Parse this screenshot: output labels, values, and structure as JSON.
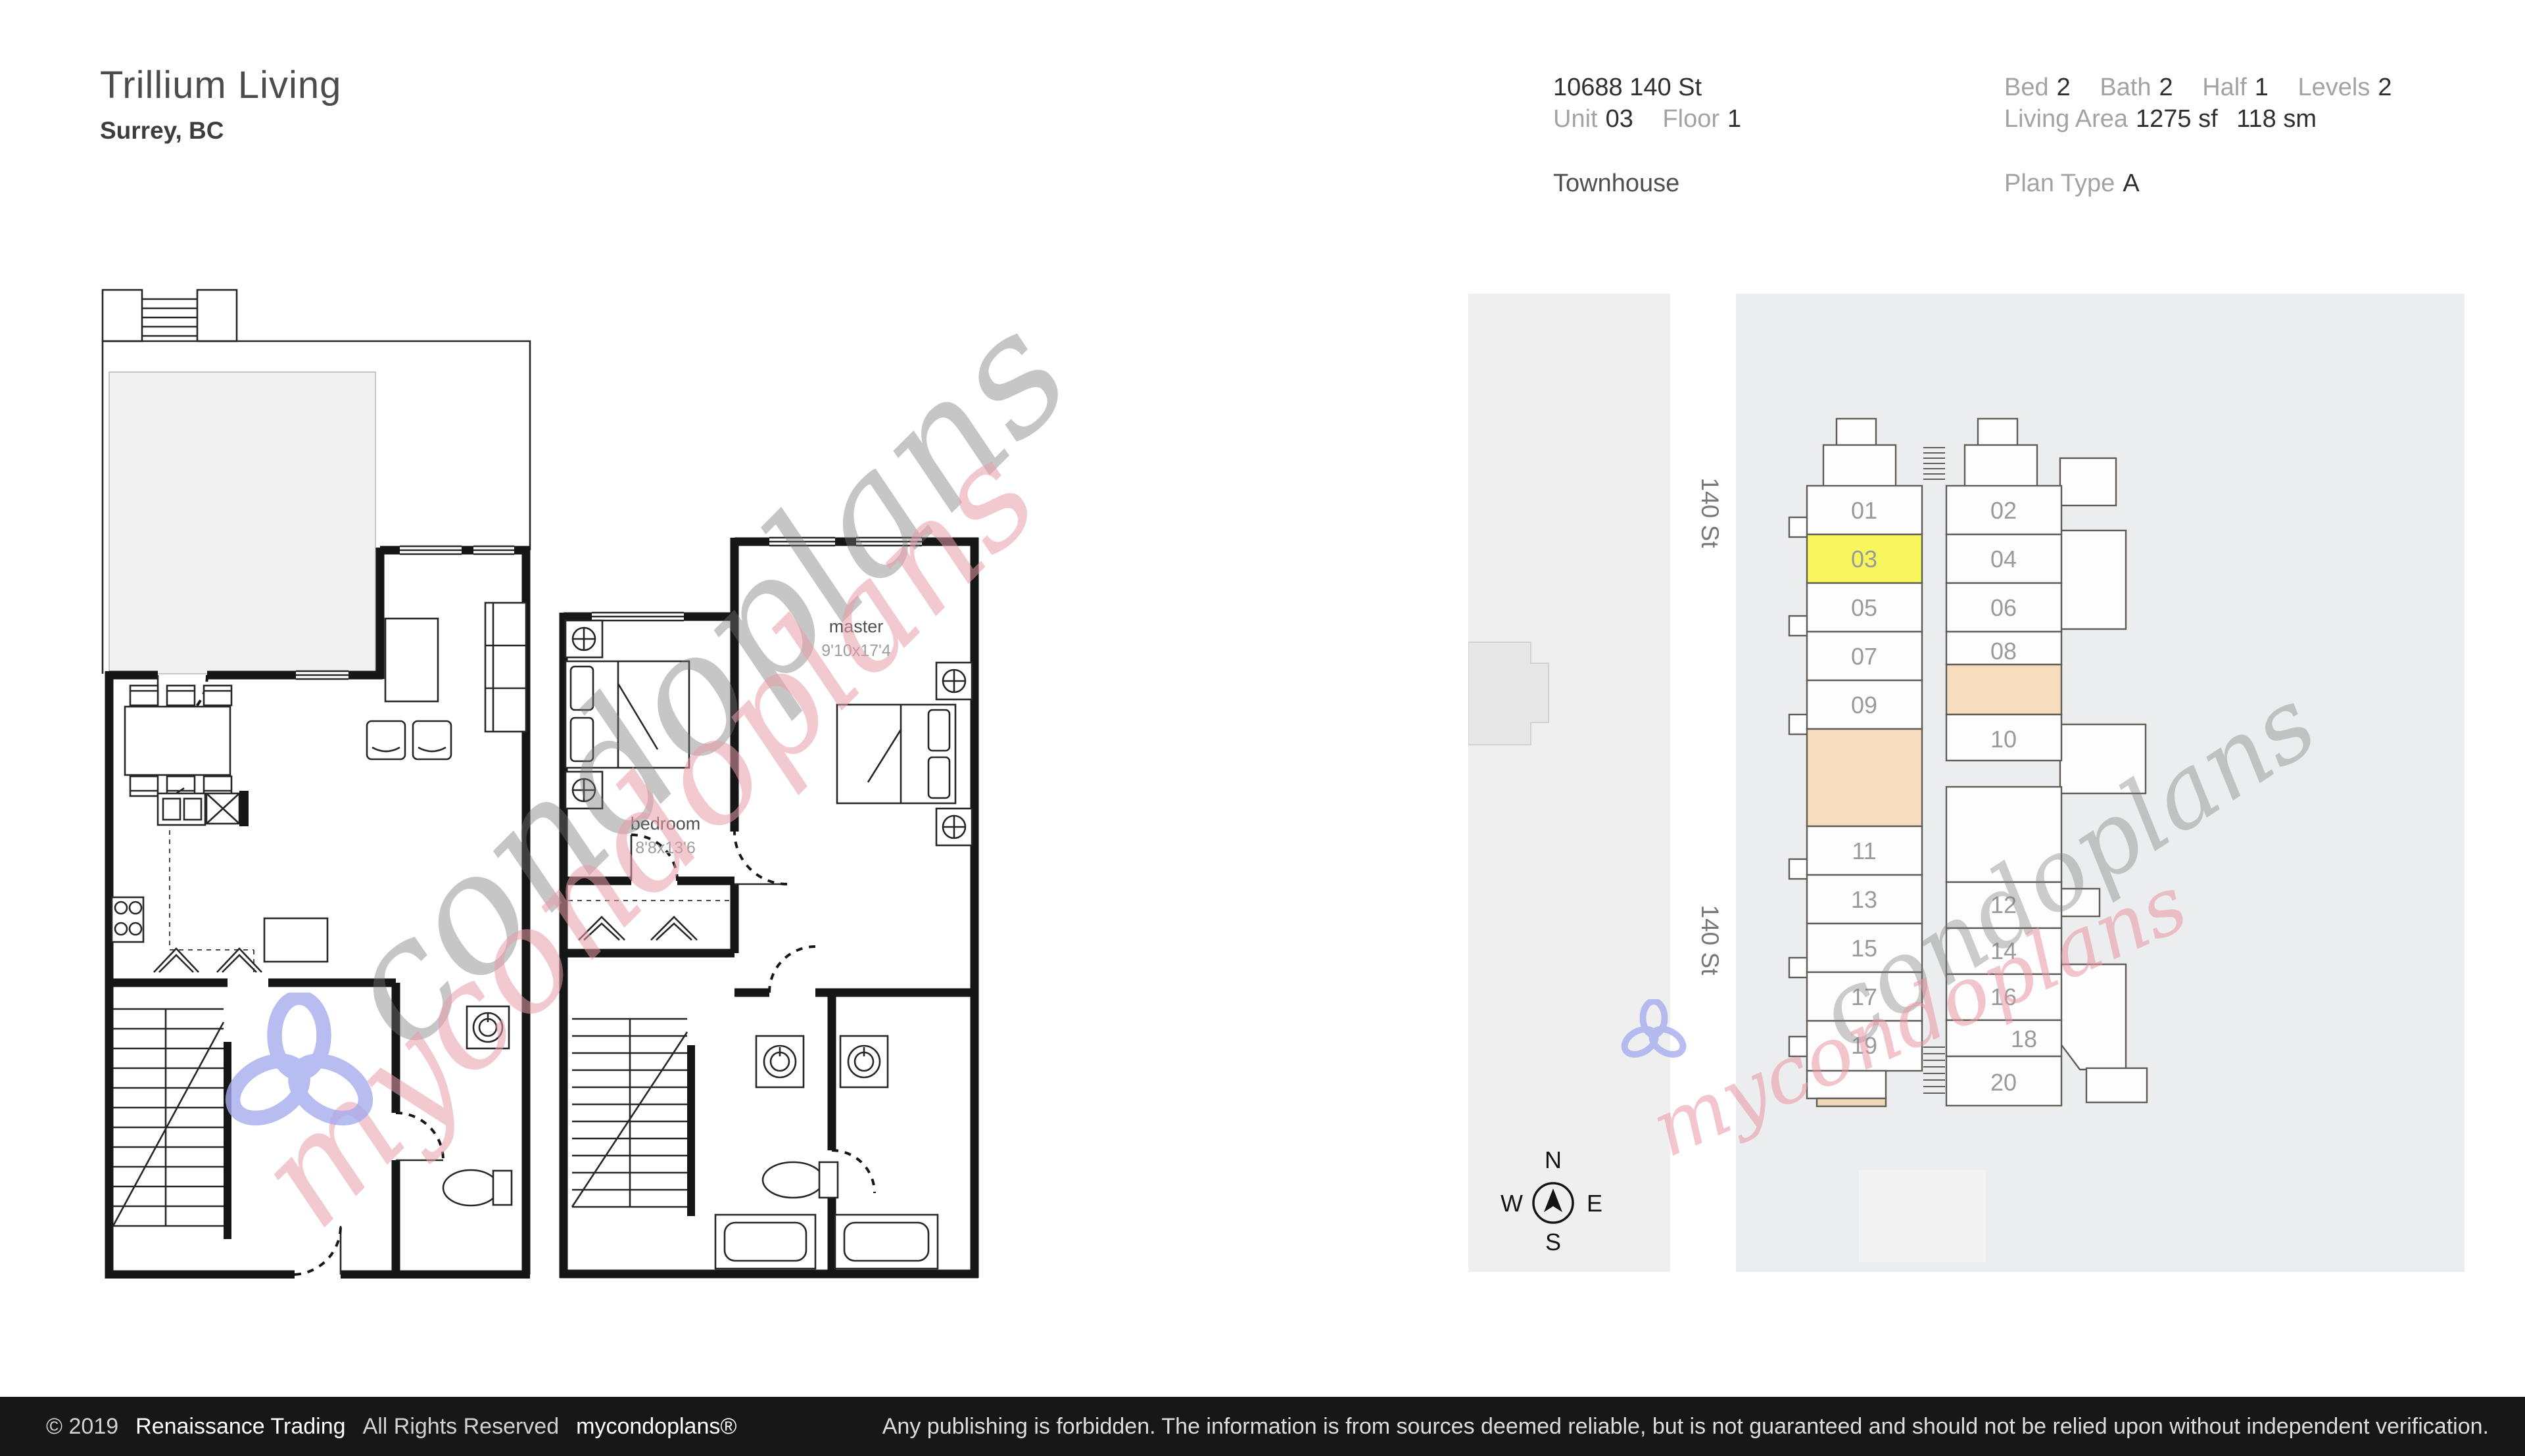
{
  "header": {
    "title": "Trillium Living",
    "city": "Surrey, BC"
  },
  "listing": {
    "address": "10688 140 St",
    "unit_label": "Unit",
    "unit": "03",
    "floor_label": "Floor",
    "floor": "1",
    "property_type": "Townhouse",
    "bed_label": "Bed",
    "bed": "2",
    "bath_label": "Bath",
    "bath": "2",
    "half_label": "Half",
    "half": "1",
    "levels_label": "Levels",
    "levels": "2",
    "living_area_label": "Living Area",
    "living_area_sf": "1275 sf",
    "living_area_sm": "118 sm",
    "plan_type_label": "Plan Type",
    "plan_type": "A"
  },
  "floorplan": {
    "master_label": "master",
    "master_dims": "9'10x17'4",
    "bedroom_label": "bedroom",
    "bedroom_dims": "8'8x13'6"
  },
  "site": {
    "street_label_top": "140 St",
    "street_label_bottom": "140 St",
    "compass": {
      "n": "N",
      "e": "E",
      "s": "S",
      "w": "W"
    },
    "highlighted_unit": "03",
    "highlight_color": "#f7f75d",
    "accent_color": "#f7dcbd",
    "units": [
      "01",
      "02",
      "03",
      "04",
      "05",
      "06",
      "07",
      "08",
      "09",
      "10",
      "11",
      "12",
      "13",
      "14",
      "15",
      "16",
      "17",
      "18",
      "19",
      "20"
    ]
  },
  "watermark": {
    "script_full": "mycondoplans",
    "script_rest": "condoplans"
  },
  "footer": {
    "copyright": "© 2019",
    "company": "Renaissance Trading",
    "rights": "All Rights Reserved",
    "brand": "mycondoplans®",
    "disclaimer": "Any publishing is forbidden.  The information is from sources deemed reliable, but is not guaranteed and should not be relied upon without independent verification."
  }
}
